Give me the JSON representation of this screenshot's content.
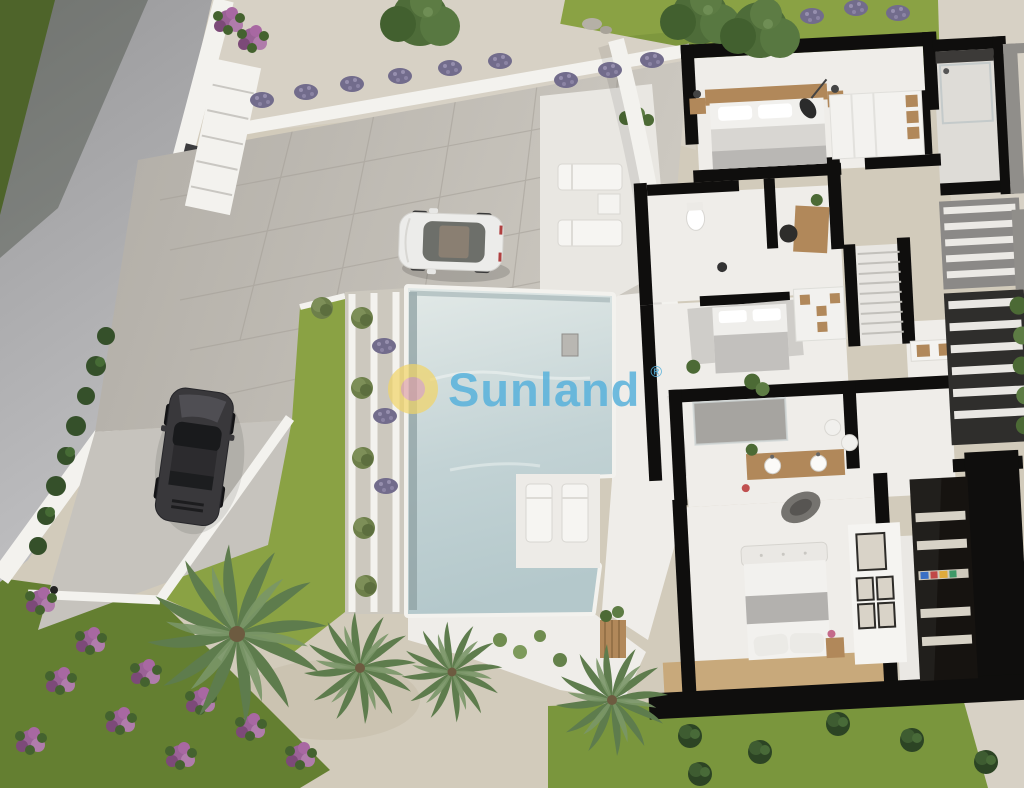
{
  "watermark": {
    "brand": "Sunland",
    "registered_mark": "®"
  },
  "palette": {
    "road": "#a4a4a6",
    "road_light": "#bdbdbf",
    "grass": "#8aa244",
    "grass_bright": "#9ab14c",
    "grass_dark": "#647f31",
    "wall": "#f3f2ee",
    "paver": "#bfbbb3",
    "gravel": "#d7d1c5",
    "sand": "#d2cbbb",
    "pool": "#c6d6d7",
    "pool_light": "#dfe7e5",
    "pool_deep": "#a9bfc2",
    "cut": "#0f0e0d",
    "floor": "#efede9",
    "floor_gray": "#dedcd7",
    "wood": "#b1885a",
    "wood_floor": "#c8a97b",
    "palm": "#5e7c4d",
    "palm_light": "#7a9668",
    "foliage": "#4c6a35",
    "hedge": "#35502a",
    "lavender": "#726c8c",
    "flower": "#9a6296",
    "white_car": "#ececea",
    "black_car": "#39383b",
    "frame_gray": "#908e8a",
    "watermark_blue": "#58b2dc",
    "logo_yellow": "#f2d566",
    "logo_pink": "#dfa2a6"
  },
  "scene": {
    "description": "Aerial 3D render of a modern villa: cutaway floor plan on the right, pool and stepped garden terraces in the center, driveway with two cars, road, palms and flowering garden.",
    "objects": [
      "road",
      "perimeter-wall",
      "entrance-gate",
      "driveway",
      "white-car",
      "black-car",
      "lawn",
      "retaining-wall-steps",
      "lavender-bushes",
      "trees",
      "pool",
      "pool-terrace-steps",
      "pool-deck",
      "sun-loungers",
      "palm-trees",
      "flower-bed",
      "hedge",
      "gravel-path",
      "villa-cutaway",
      "bedroom-1",
      "bathroom-1",
      "bathroom-2-and-study",
      "bedroom-2",
      "staircase",
      "kitchen",
      "bathroom-3",
      "master-bedroom",
      "walk-in-closet",
      "louver-panels",
      "window-frames",
      "garden-shrubs",
      "sunland-watermark"
    ]
  }
}
